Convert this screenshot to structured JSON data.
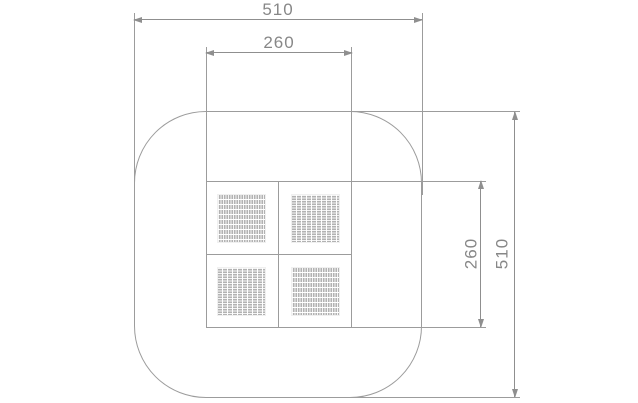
{
  "colors": {
    "background": "#ffffff",
    "line": "#9c9c9c",
    "dimension_line": "#8f8f8f",
    "text": "#878787",
    "hatch": "#b2b2b2"
  },
  "dimensions": {
    "top_outer_width": "510",
    "top_inner_width": "260",
    "right_inner_height": "260",
    "right_outer_height": "510"
  },
  "panels": {
    "top_left_weave": "horizontal",
    "top_right_weave": "vertical",
    "bottom_left_weave": "vertical",
    "bottom_right_weave": "horizontal"
  }
}
